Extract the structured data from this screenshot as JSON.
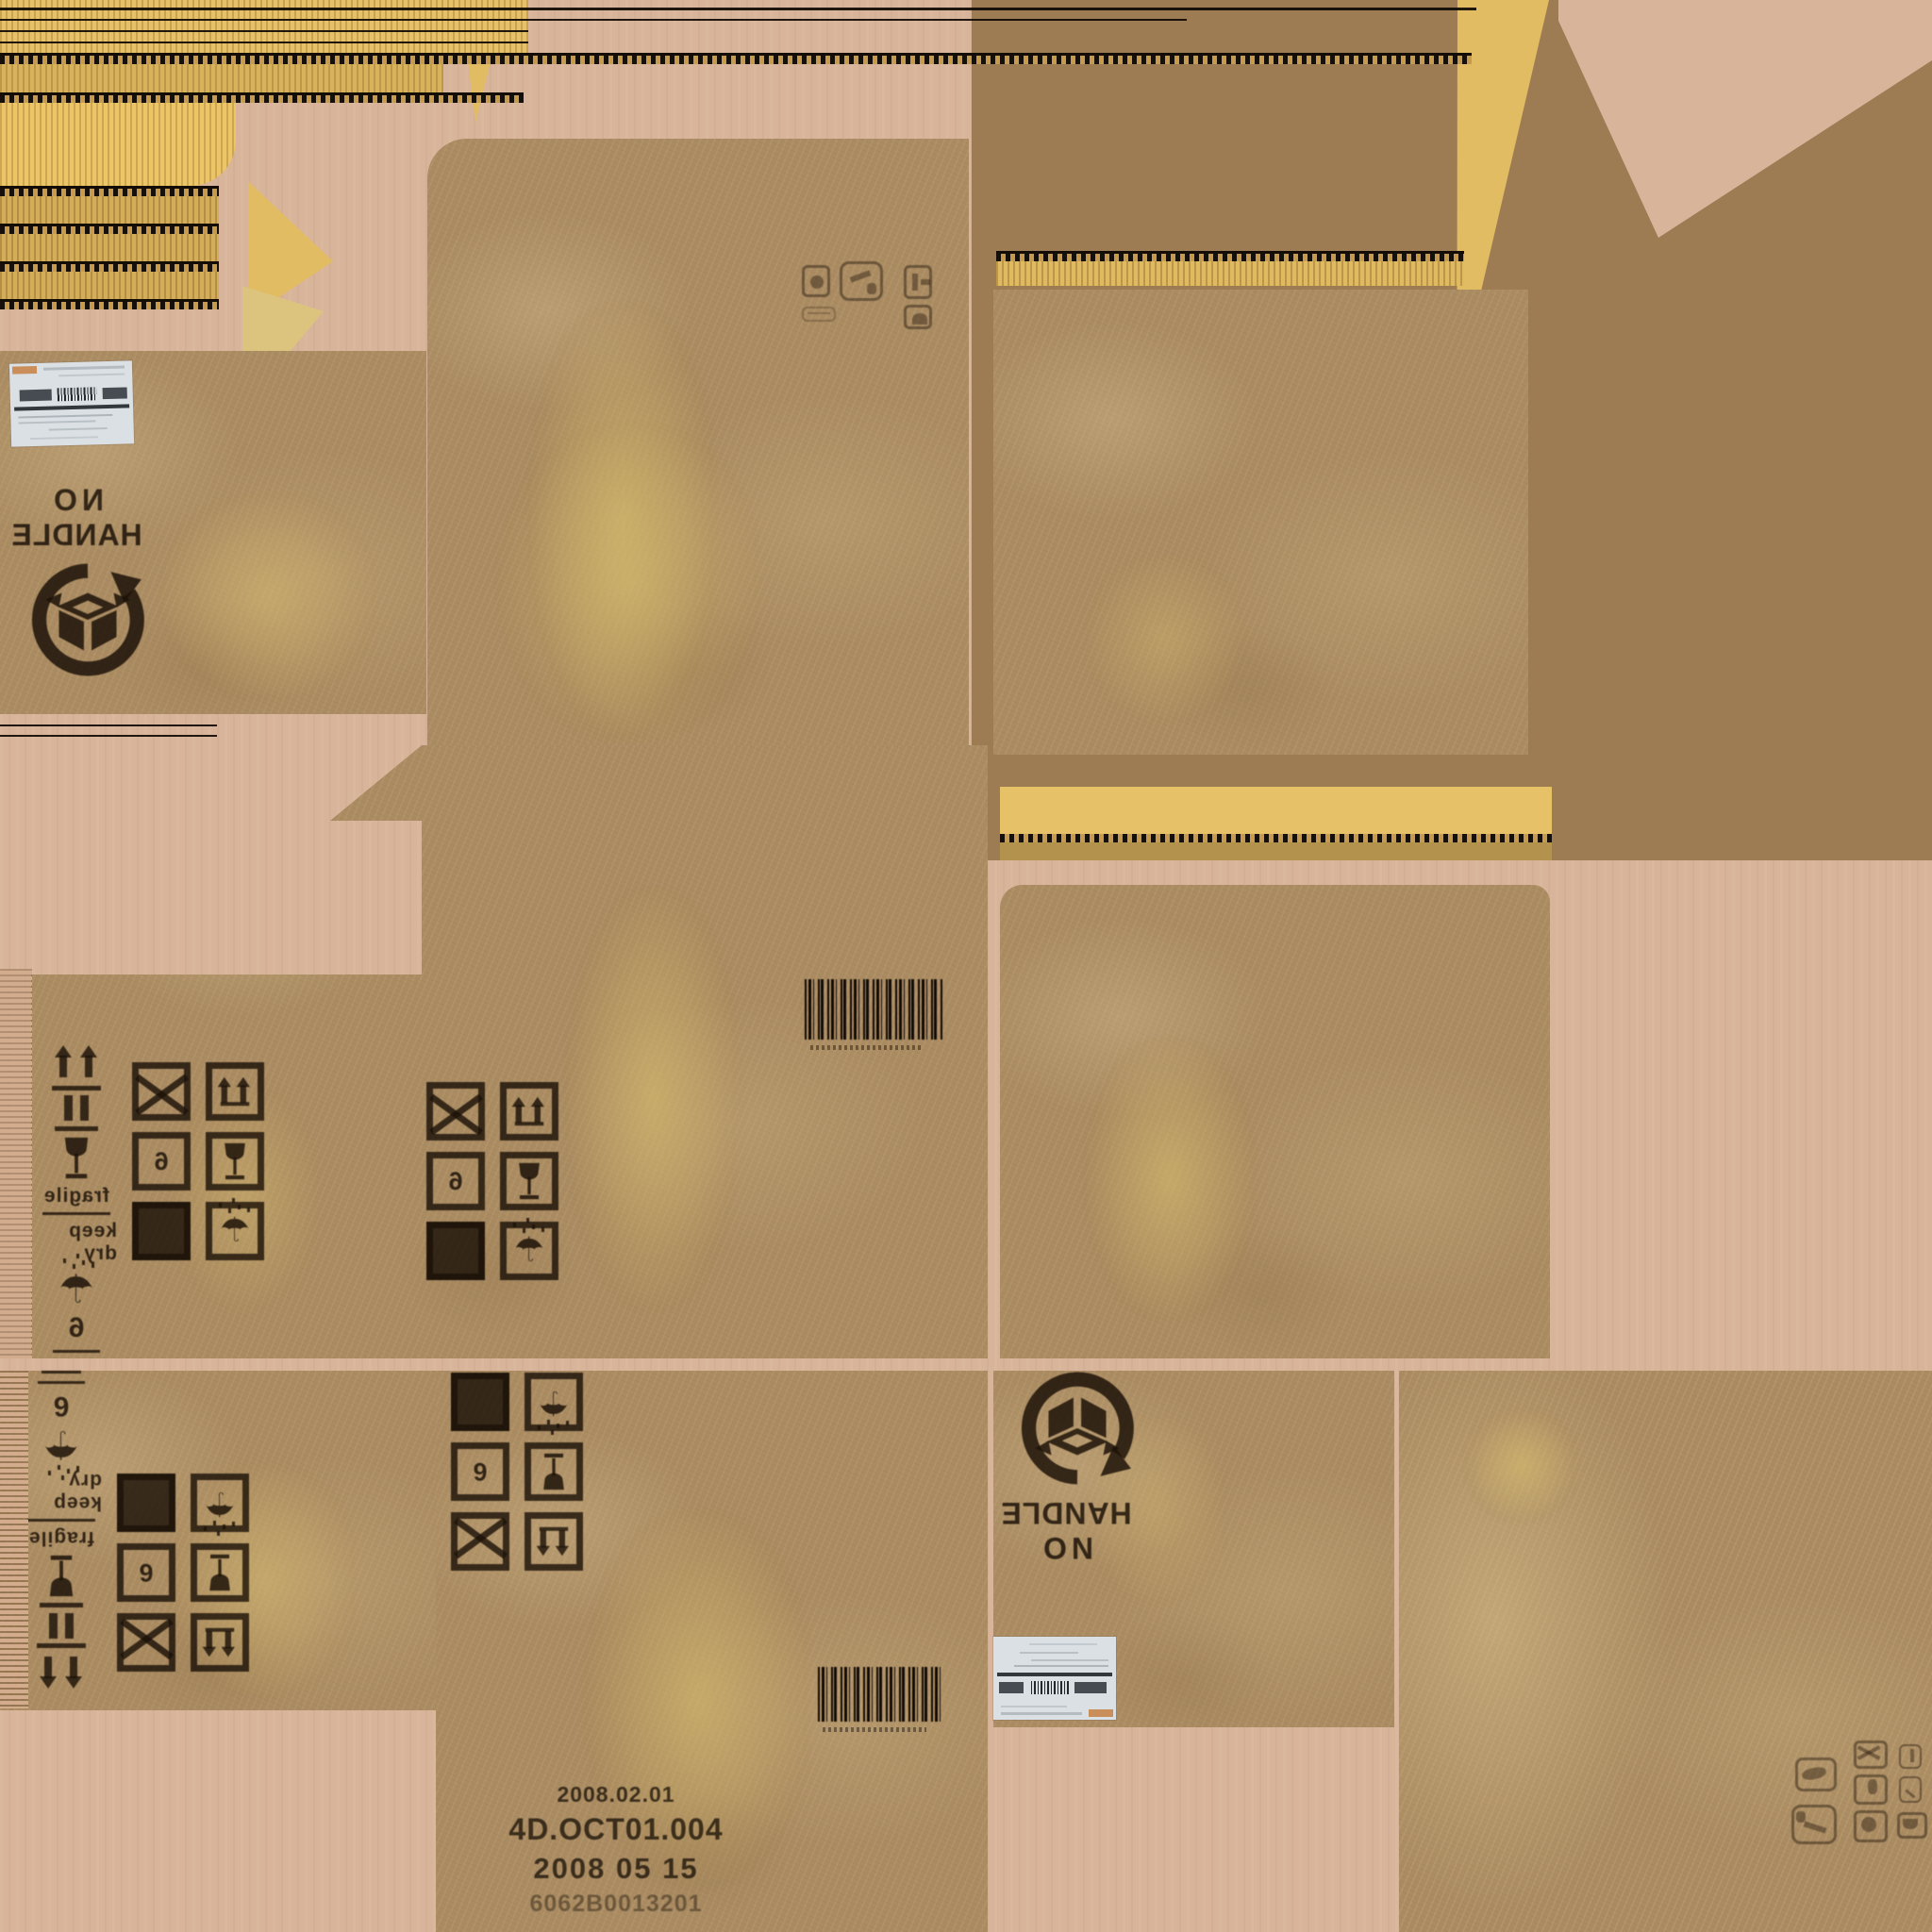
{
  "atlas": {
    "description": "cardboard shipping box packaging texture atlas"
  },
  "colors": {
    "background": "#d8b49a",
    "flat_brown": "#9d7b53",
    "cardboard": "#ab8c62",
    "corrugation_yellow": "#e6c167",
    "ink": "#2a2015",
    "label_white": "#dbe0e4",
    "stain_yellow": "#dbc170"
  },
  "icons": {
    "keep_dry_umbrella": "☂",
    "this_way_up": "two-up-arrows-over-baseline",
    "do_not_clamp": "double-bars-over-baseline",
    "fragile_glass": "wine-glass",
    "do_not_stack": "crossed-box",
    "solid_patch": "filled-square",
    "recycle_box": "circular-arrow-around-open-box",
    "barcode": "vertical-bars"
  },
  "stamps": {
    "no_handle": {
      "line1": "NO",
      "line2": "HANDLE"
    },
    "handling": {
      "fragile": "fragile",
      "keep_dry": "keep dry",
      "stack_limit": "6"
    },
    "production": {
      "line1": "2008.02.01",
      "line2": "4D.OCT01.004",
      "line3": "2008 05 15",
      "line4": "6062B0013201"
    }
  }
}
